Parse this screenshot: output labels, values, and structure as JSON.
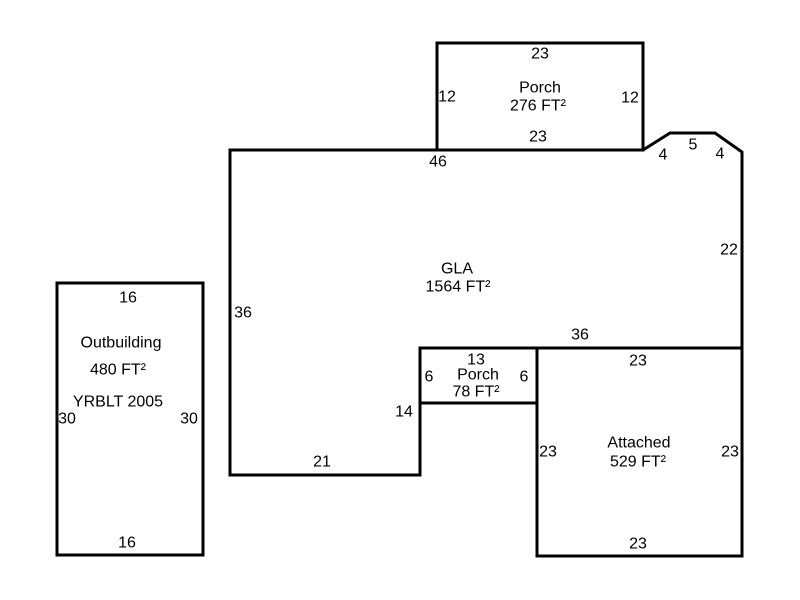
{
  "canvas": {
    "width": 800,
    "height": 600,
    "background": "#ffffff",
    "line_color": "#000000",
    "line_width": 3,
    "text_color": "#000000",
    "font_size": 16
  },
  "sketch": {
    "regions": [
      {
        "name": "gla",
        "label": "GLA",
        "area": "1564 FT²",
        "points": [
          [
            230,
            150
          ],
          [
            643,
            150
          ],
          [
            670,
            133
          ],
          [
            715,
            133
          ],
          [
            742,
            152
          ],
          [
            742,
            348
          ],
          [
            420,
            348
          ],
          [
            420,
            475
          ],
          [
            230,
            475
          ]
        ]
      },
      {
        "name": "porch-276",
        "label": "Porch",
        "area": "276 FT²",
        "points": [
          [
            437,
            43
          ],
          [
            643,
            43
          ],
          [
            643,
            150
          ],
          [
            437,
            150
          ]
        ]
      },
      {
        "name": "porch-78",
        "label": "Porch",
        "area": "78 FT²",
        "points": [
          [
            420,
            348
          ],
          [
            537,
            348
          ],
          [
            537,
            403
          ],
          [
            420,
            403
          ]
        ]
      },
      {
        "name": "attached",
        "label": "Attached",
        "area": "529 FT²",
        "points": [
          [
            537,
            348
          ],
          [
            742,
            348
          ],
          [
            742,
            556
          ],
          [
            537,
            556
          ]
        ]
      },
      {
        "name": "outbuilding",
        "label": "Outbuilding",
        "area": "480 FT²",
        "points": [
          [
            57,
            283
          ],
          [
            203,
            283
          ],
          [
            203,
            555
          ],
          [
            57,
            555
          ]
        ]
      }
    ],
    "labels": [
      {
        "name": "porch276-dim-top",
        "text": "23",
        "x": 540,
        "y": 54
      },
      {
        "name": "porch276-dim-left",
        "text": "12",
        "x": 447,
        "y": 97
      },
      {
        "name": "porch276-title",
        "text": "Porch",
        "x": 540,
        "y": 88
      },
      {
        "name": "porch276-area",
        "text": "276 FT²",
        "x": 538,
        "y": 106
      },
      {
        "name": "porch276-dim-right",
        "text": "12",
        "x": 630,
        "y": 98
      },
      {
        "name": "porch276-dim-bottom",
        "text": "23",
        "x": 538,
        "y": 137
      },
      {
        "name": "gla-dim-top",
        "text": "46",
        "x": 438,
        "y": 162
      },
      {
        "name": "gla-dim-bay-left",
        "text": "4",
        "x": 663,
        "y": 155
      },
      {
        "name": "gla-dim-bay-mid",
        "text": "5",
        "x": 693,
        "y": 145
      },
      {
        "name": "gla-dim-bay-right",
        "text": "4",
        "x": 720,
        "y": 154
      },
      {
        "name": "gla-dim-right",
        "text": "22",
        "x": 729,
        "y": 250
      },
      {
        "name": "gla-dim-left",
        "text": "36",
        "x": 243,
        "y": 313
      },
      {
        "name": "gla-title",
        "text": "GLA",
        "x": 457,
        "y": 269
      },
      {
        "name": "gla-area",
        "text": "1564 FT²",
        "x": 458,
        "y": 287
      },
      {
        "name": "gla-dim-bottom-right",
        "text": "36",
        "x": 580,
        "y": 335
      },
      {
        "name": "porch78-dim-top",
        "text": "13",
        "x": 476,
        "y": 360
      },
      {
        "name": "porch78-dim-left",
        "text": "6",
        "x": 429,
        "y": 377
      },
      {
        "name": "porch78-title",
        "text": "Porch",
        "x": 478,
        "y": 375
      },
      {
        "name": "porch78-dim-right",
        "text": "6",
        "x": 524,
        "y": 377
      },
      {
        "name": "porch78-area",
        "text": "78 FT²",
        "x": 476,
        "y": 392
      },
      {
        "name": "gla-dim-step",
        "text": "14",
        "x": 404,
        "y": 412
      },
      {
        "name": "gla-dim-bottom-left",
        "text": "21",
        "x": 322,
        "y": 462
      },
      {
        "name": "attached-dim-top",
        "text": "23",
        "x": 638,
        "y": 361
      },
      {
        "name": "attached-dim-left",
        "text": "23",
        "x": 548,
        "y": 452
      },
      {
        "name": "attached-title",
        "text": "Attached",
        "x": 639,
        "y": 443
      },
      {
        "name": "attached-area",
        "text": "529 FT²",
        "x": 638,
        "y": 462
      },
      {
        "name": "attached-dim-right",
        "text": "23",
        "x": 730,
        "y": 452
      },
      {
        "name": "attached-dim-bottom",
        "text": "23",
        "x": 638,
        "y": 544
      },
      {
        "name": "outbuilding-dim-top",
        "text": "16",
        "x": 128,
        "y": 298
      },
      {
        "name": "outbuilding-title",
        "text": "Outbuilding",
        "x": 121,
        "y": 343
      },
      {
        "name": "outbuilding-area",
        "text": "480 FT²",
        "x": 118,
        "y": 370
      },
      {
        "name": "outbuilding-yrblt",
        "text": "YRBLT 2005",
        "x": 118,
        "y": 402
      },
      {
        "name": "outbuilding-dim-left",
        "text": "30",
        "x": 67,
        "y": 419
      },
      {
        "name": "outbuilding-dim-right",
        "text": "30",
        "x": 189,
        "y": 419
      },
      {
        "name": "outbuilding-dim-bottom",
        "text": "16",
        "x": 127,
        "y": 543
      }
    ]
  }
}
